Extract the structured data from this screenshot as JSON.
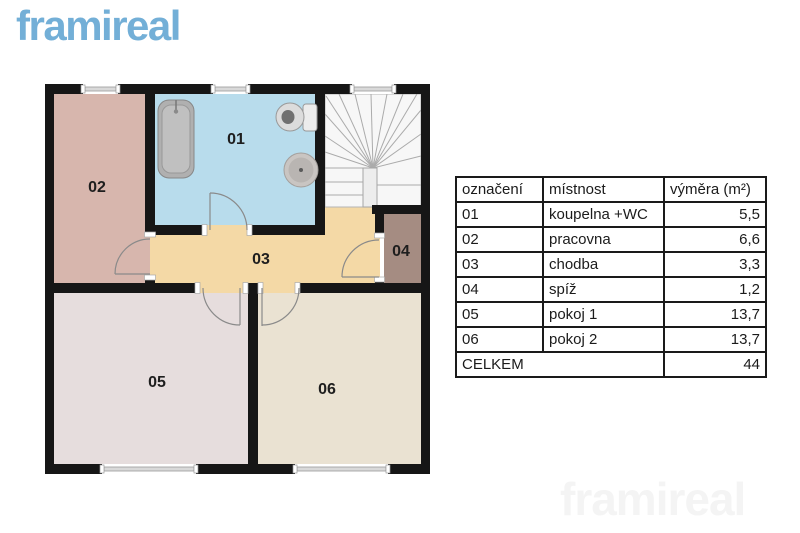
{
  "logo": {
    "text": "framireal",
    "color": "#73afd7"
  },
  "watermark": {
    "text": "framireal"
  },
  "plan": {
    "labels": {
      "r01": "01",
      "r02": "02",
      "r03": "03",
      "r04": "04",
      "r05": "05",
      "r06": "06"
    }
  },
  "colors": {
    "room01": "#b8dcec",
    "room02": "#d7b6ad",
    "room03": "#f4d9a6",
    "room04": "#a58c82",
    "room05": "#e6dddd",
    "room06": "#eae2d2",
    "wall": "#161616",
    "stairs_bg": "#f7f7f7"
  },
  "table": {
    "headers": [
      "označení",
      "místnost",
      "výměra (m²)"
    ],
    "rows": [
      {
        "code": "01",
        "name": "koupelna +WC",
        "area": "5,5"
      },
      {
        "code": "02",
        "name": "pracovna",
        "area": "6,6"
      },
      {
        "code": "03",
        "name": "chodba",
        "area": "3,3"
      },
      {
        "code": "04",
        "name": "spíž",
        "area": "1,2"
      },
      {
        "code": "05",
        "name": "pokoj 1",
        "area": "13,7"
      },
      {
        "code": "06",
        "name": "pokoj 2",
        "area": "13,7"
      }
    ],
    "total_label": "CELKEM",
    "total_value": "44"
  }
}
